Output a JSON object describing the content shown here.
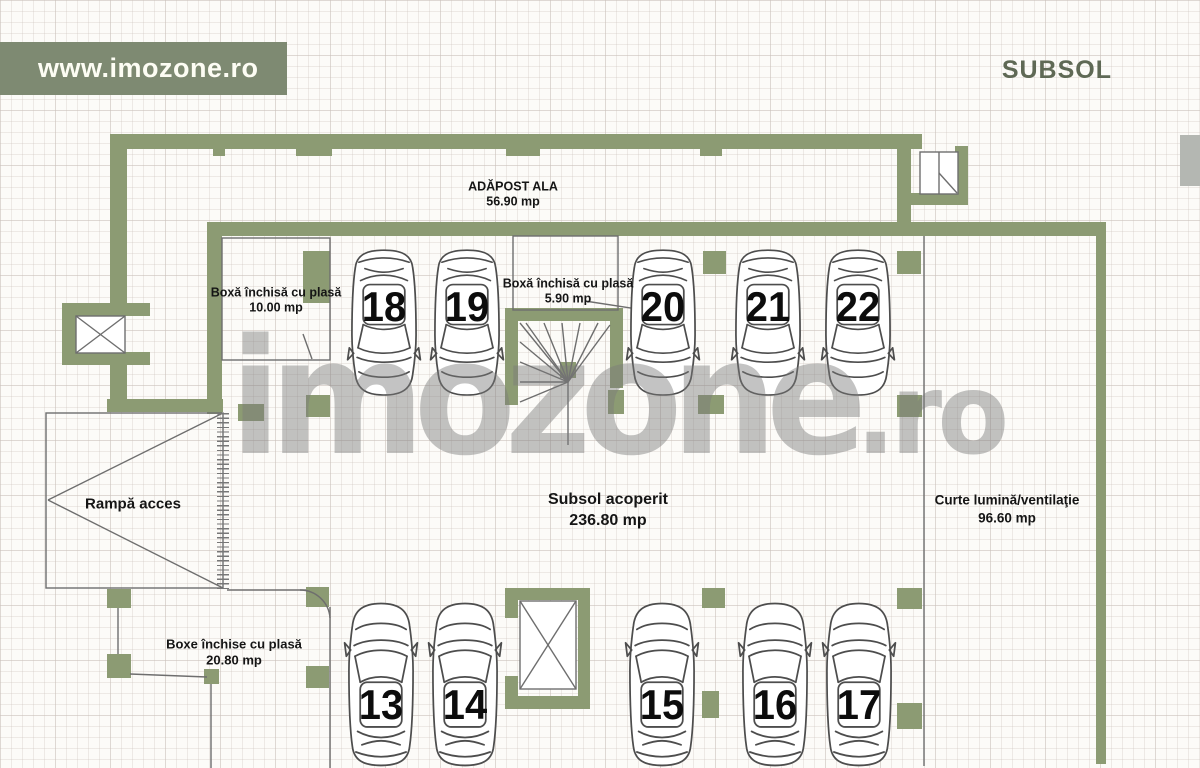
{
  "header": {
    "website": "www.imozone.ro",
    "floor_label": "SUBSOL"
  },
  "watermark": {
    "main": "imozone",
    "tld": ".ro"
  },
  "rooms": {
    "adapost": {
      "name": "ADĂPOST ALA",
      "area": "56.90 mp"
    },
    "boxa10": {
      "name": "Boxă închisă cu plasă",
      "area": "10.00 mp"
    },
    "boxa590": {
      "name": "Boxă închisă cu plasă",
      "area": "5.90 mp"
    },
    "rampa": {
      "name": "Rampă acces",
      "area": ""
    },
    "subsol": {
      "name": "Subsol acoperit",
      "area": "236.80 mp"
    },
    "curte": {
      "name": "Curte lumină/ventilaţie",
      "area": "96.60 mp"
    },
    "boxe": {
      "name": "Boxe închise cu plasă",
      "area": "20.80 mp"
    }
  },
  "parking_spots": {
    "top_row": [
      "18",
      "19",
      "20",
      "21",
      "22"
    ],
    "bottom_row": [
      "13",
      "14",
      "15",
      "16",
      "17"
    ]
  },
  "colors": {
    "wall_green": "#8c9b73",
    "banner_bg": "#7e8a72",
    "title_color": "#5f6955",
    "watermark_gray": "rgba(122,122,122,0.45)",
    "label_text": "#151515"
  }
}
